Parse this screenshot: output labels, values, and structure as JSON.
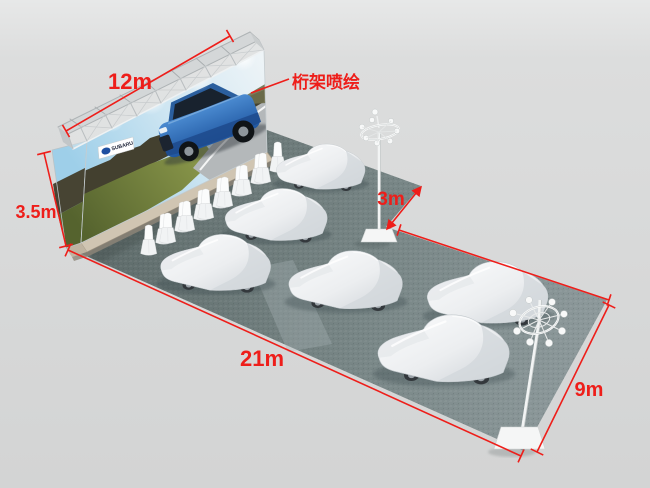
{
  "dimensions": {
    "truss_width": "12m",
    "wall_height": "3.5m",
    "side_offset": "3m",
    "floor_length": "21m",
    "floor_depth": "9m"
  },
  "callouts": {
    "truss_banner_label": "桁架喷绘"
  },
  "banner": {
    "brand_logo_text": "SUBARU"
  },
  "colors": {
    "annotation_red": "#ee1e1a",
    "background": "#d8d9d9",
    "carpet_dark": "#5d6a69",
    "carpet_light": "#8e9a9c",
    "car_cover_white": "#f4f5f6",
    "suv_blue": "#2f6fb5",
    "truss_silver": "#c9cdce",
    "wall_base_beige": "#d0c5b2"
  },
  "objects": {
    "covered_car_count": 6,
    "covered_chair_count": 14,
    "light_pole_count": 2
  }
}
